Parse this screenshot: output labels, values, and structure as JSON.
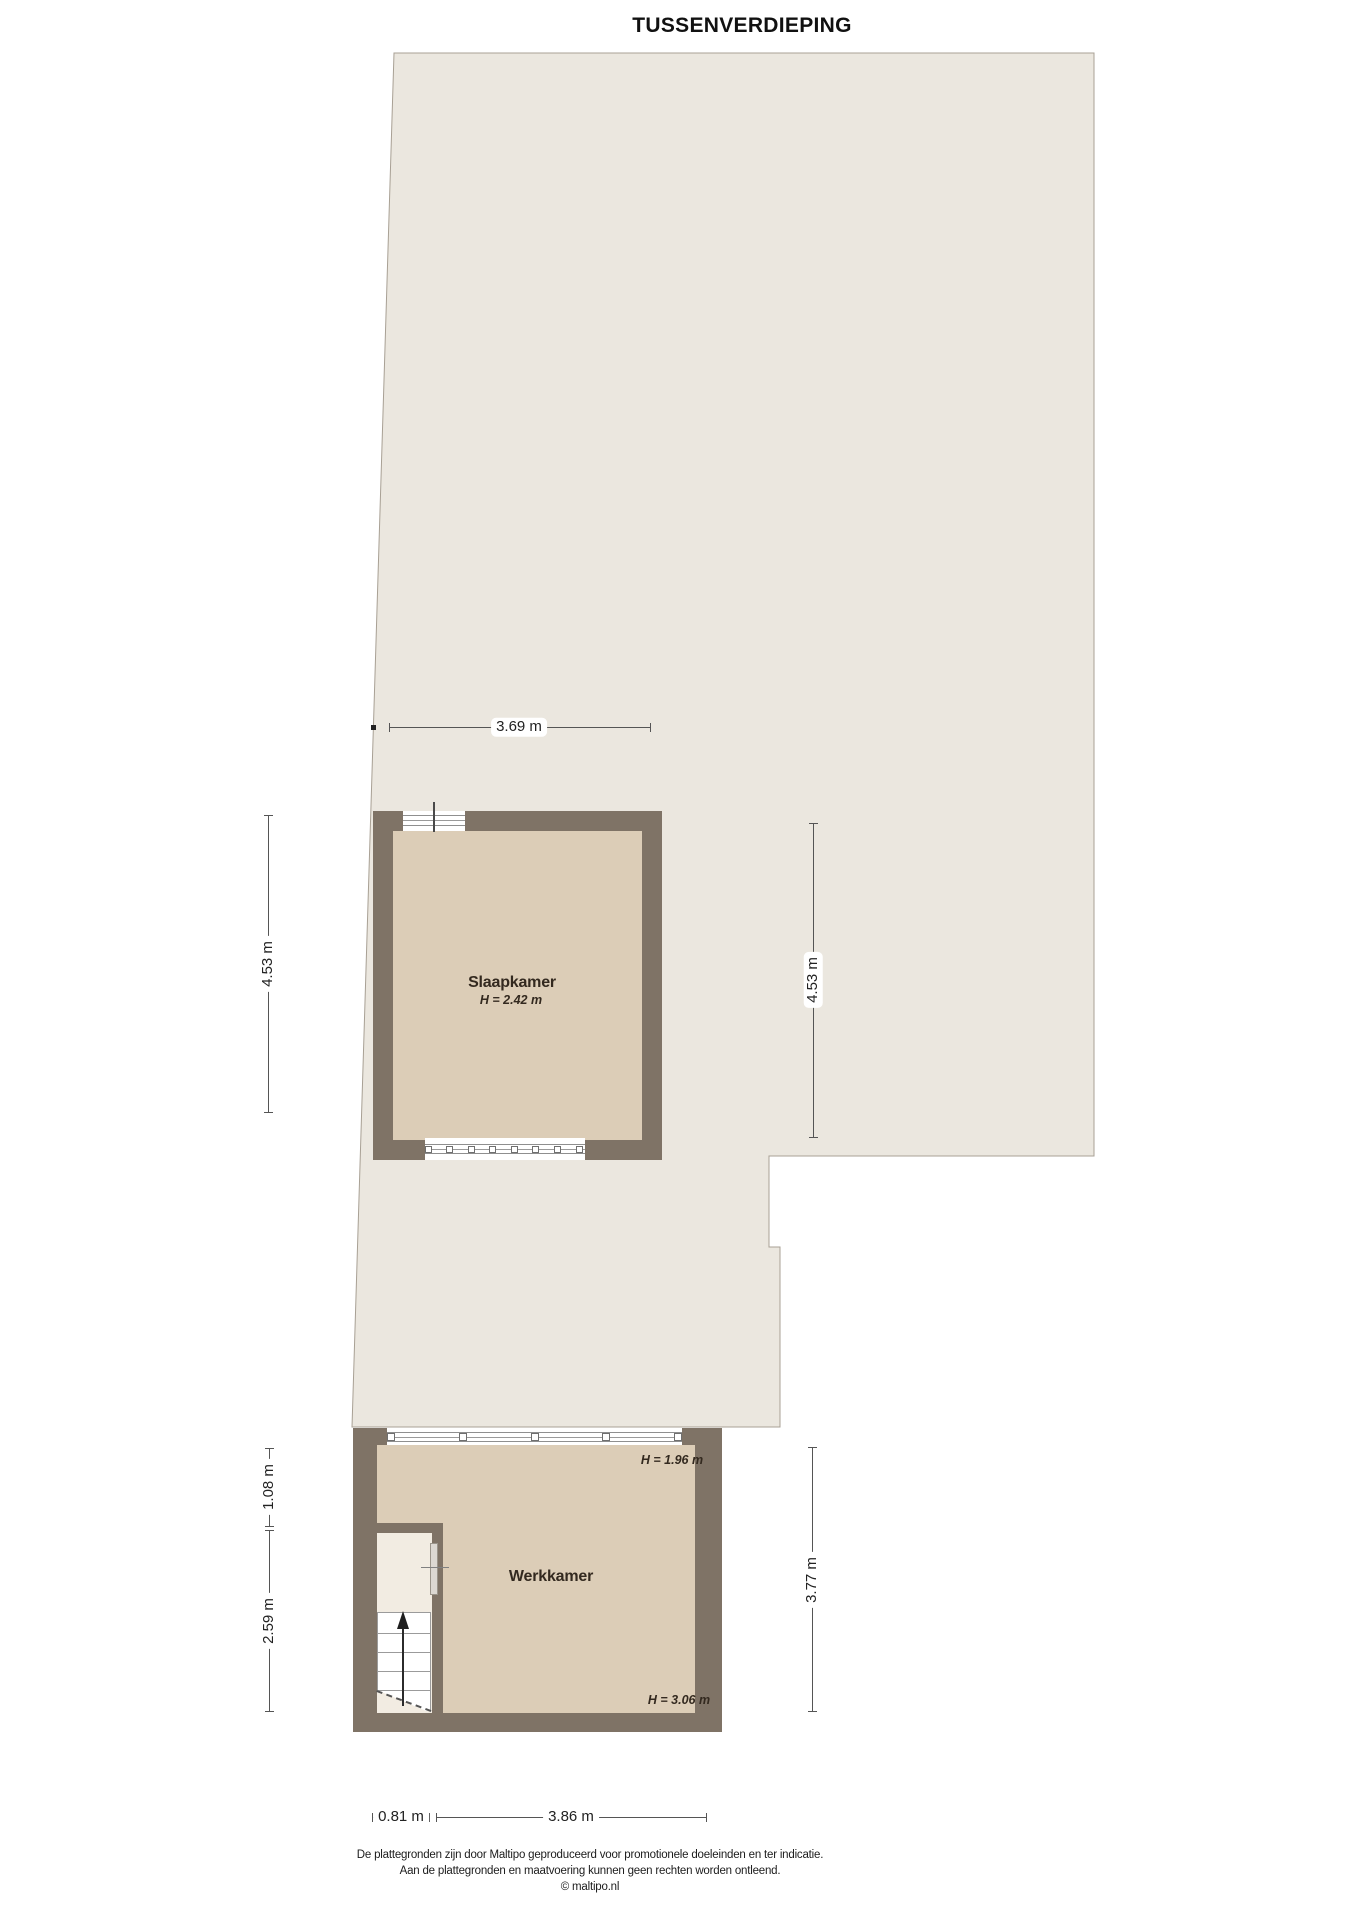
{
  "title": "TUSSENVERDIEPING",
  "rooms": {
    "slaapkamer": {
      "name": "Slaapkamer",
      "height": "H = 2.42 m"
    },
    "werkkamer": {
      "name": "Werkkamer",
      "height_front": "H = 1.96 m",
      "height_back": "H = 3.06 m"
    }
  },
  "dimensions": {
    "top_width": "3.69 m",
    "left_upper": "4.53 m",
    "right_upper": "4.53 m",
    "left_mid": "1.08 m",
    "left_lower": "2.59 m",
    "right_lower": "3.77 m",
    "bottom_left": "0.81 m",
    "bottom_right": "3.86 m"
  },
  "footer": {
    "line1": "De plattegronden zijn door Maltipo geproduceerd voor promotionele doeleinden en ter indicatie.",
    "line2": "Aan de plattegronden en maatvoering kunnen geen rechten worden ontleend.",
    "line3": "© maltipo.nl"
  },
  "colors": {
    "area_fill": "#EBE7DF",
    "area_outline": "#A8A094",
    "wall": "#7F7366",
    "room_floor": "#DCCDB7",
    "stairwell_floor": "#F2ECE2",
    "dimension_line": "#555555",
    "label_text": "#33291F"
  }
}
